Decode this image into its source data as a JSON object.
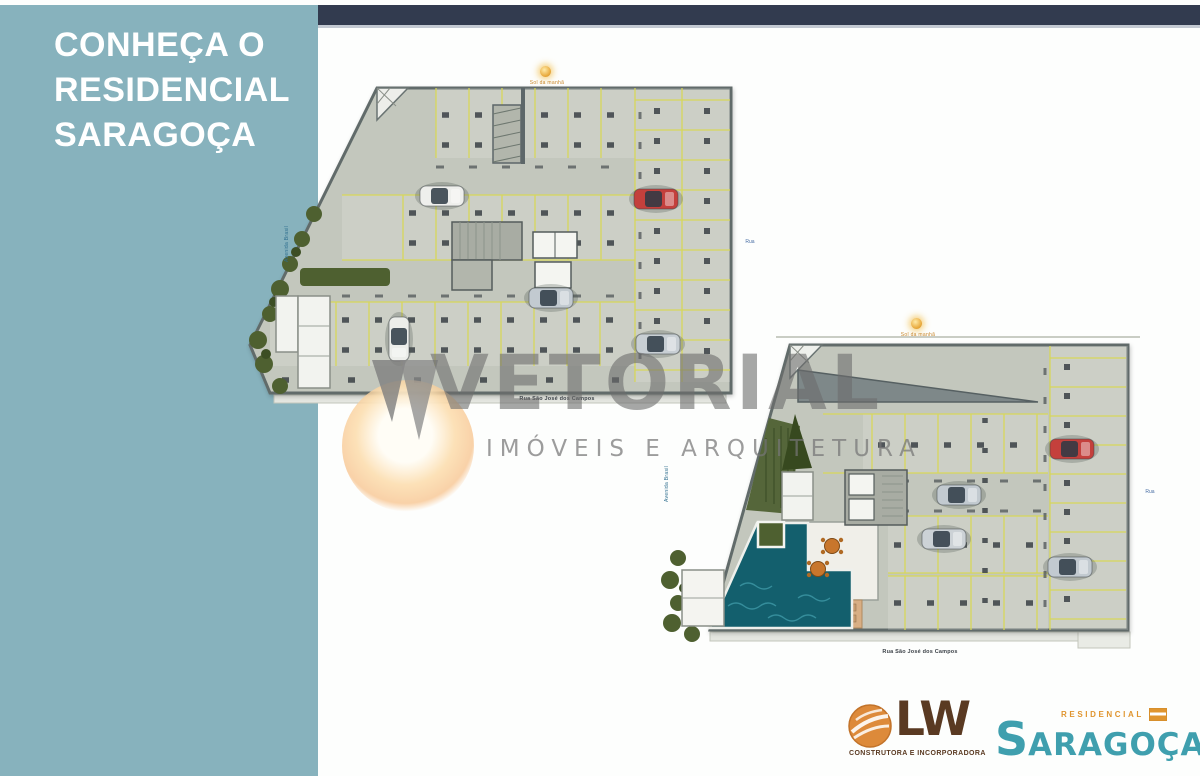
{
  "sidebar": {
    "title_lines": [
      "CONHEÇA O",
      "RESIDENCIAL",
      "SARAGOÇA"
    ],
    "background": "#87b2bd"
  },
  "header": {
    "background": "#323b4f"
  },
  "watermark": {
    "brand": "VETORIAL",
    "tagline": "IMÓVEIS E ARQUITETURA"
  },
  "plans": [
    {
      "name": "Pavimento garagem",
      "sun_label": "Sol da manhã",
      "street_bottom": "Rua São José dos Campos",
      "street_side": "Avenida Brasil",
      "street_right": "Rua"
    },
    {
      "name": "Pavimento térreo",
      "sun_label": "Sol da manhã",
      "street_bottom": "Rua São José dos Campos",
      "street_side": "Avenida Brasil",
      "street_right": "Rua"
    }
  ],
  "logos": {
    "lw": {
      "initials": "LW",
      "tagline": "CONSTRUTORA E INCORPORADORA"
    },
    "saragoca": {
      "category": "RESIDENCIAL",
      "name_initial": "S",
      "name_rest": "ARAGOÇA"
    }
  },
  "colors": {
    "sidebar_teal": "#87b2bd",
    "header_navy": "#323b4f",
    "plan_floor": "#c3c7bd",
    "stall_yellow": "#d8d855",
    "pool_teal": "#135f6d",
    "hedge_green": "#4e6030",
    "accent_orange": "#e0952f",
    "brand_teal": "#3f9fae",
    "watermark_gray": "#6c6c6c"
  }
}
